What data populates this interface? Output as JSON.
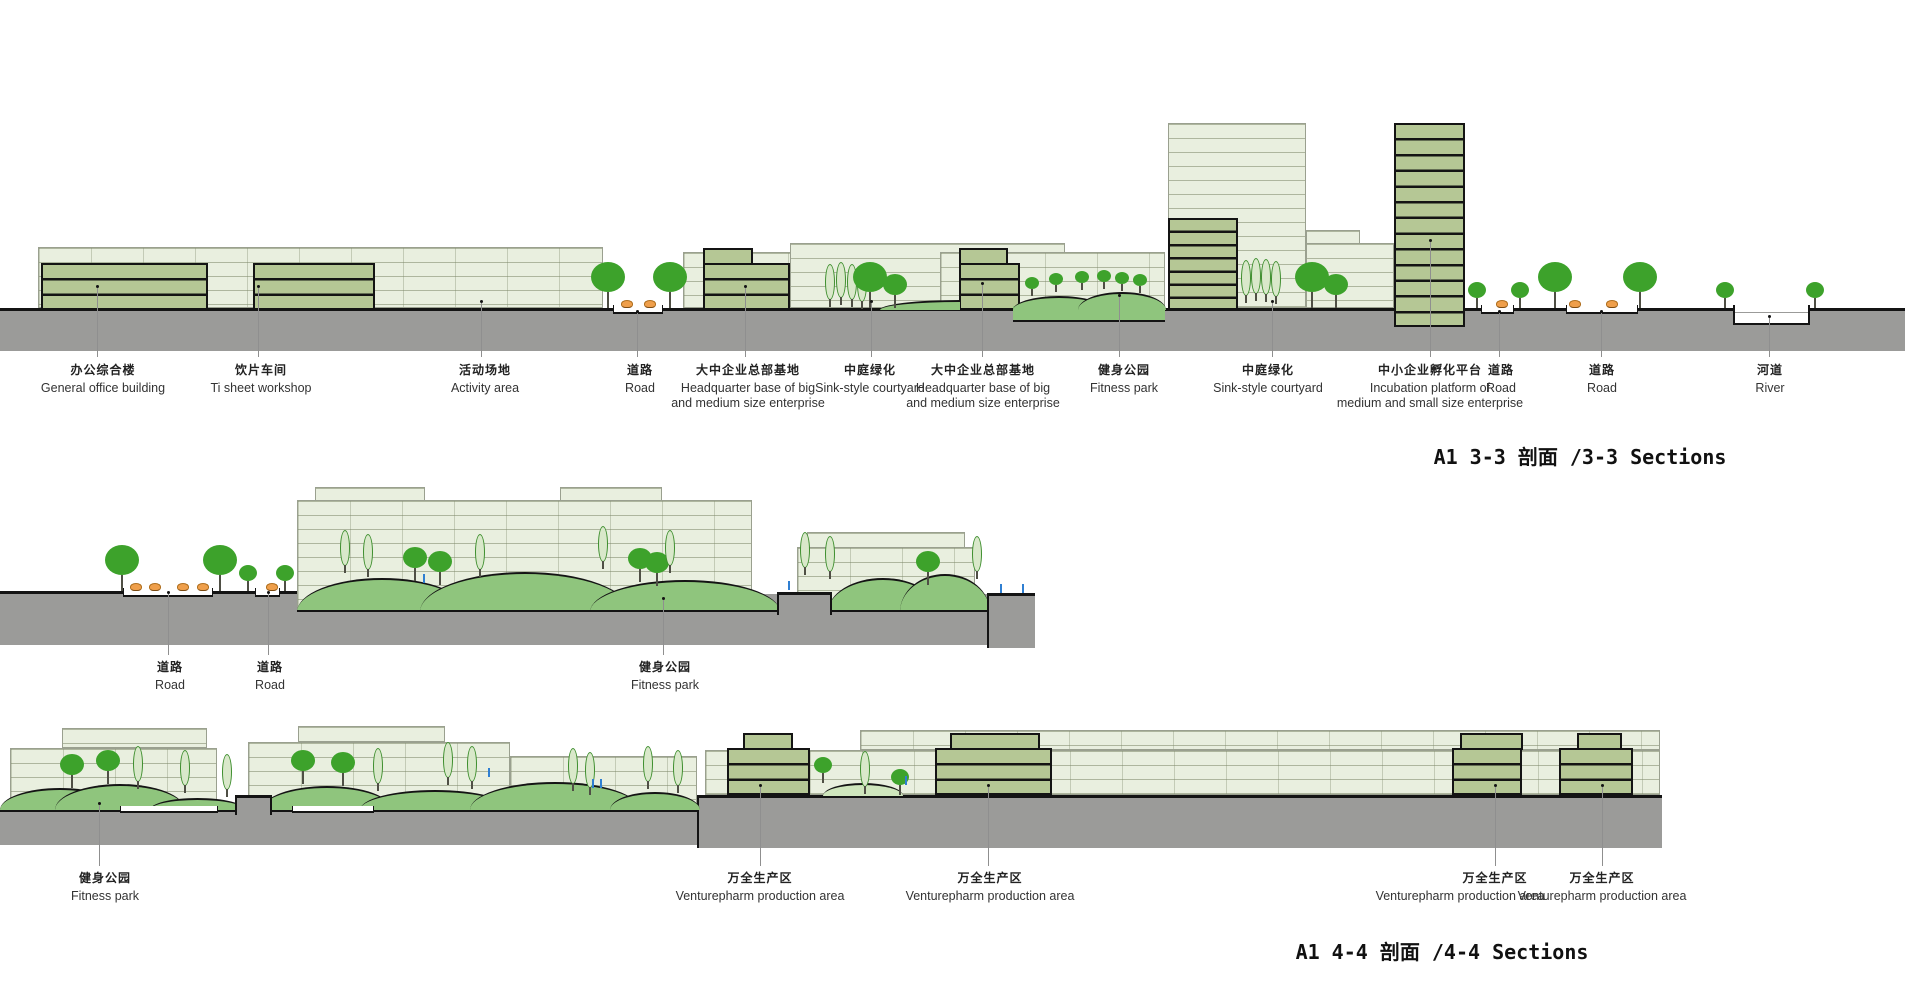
{
  "sections": [
    {
      "id": "3-3",
      "title": "A1 3-3 剖面 /3-3 Sections",
      "labels": [
        {
          "zh": "办公综合楼",
          "en": "General office building"
        },
        {
          "zh": "饮片车间",
          "en": "Ti sheet workshop"
        },
        {
          "zh": "活动场地",
          "en": "Activity area"
        },
        {
          "zh": "道路",
          "en": "Road"
        },
        {
          "zh": "大中企业总部基地",
          "en": "Headquarter base of big",
          "en2": "and medium size enterprise"
        },
        {
          "zh": "中庭绿化",
          "en": "Sink-style courtyard"
        },
        {
          "zh": "大中企业总部基地",
          "en": "Headquarter base of big",
          "en2": "and medium size enterprise"
        },
        {
          "zh": "健身公园",
          "en": "Fitness park"
        },
        {
          "zh": "中庭绿化",
          "en": "Sink-style courtyard"
        },
        {
          "zh": "中小企业孵化平台",
          "en": "Incubation platform of",
          "en2": "medium and small size enterprise"
        },
        {
          "zh": "道路",
          "en": "Road"
        },
        {
          "zh": "道路",
          "en": "Road"
        },
        {
          "zh": "河道",
          "en": "River"
        }
      ]
    },
    {
      "id": "middle-strip",
      "title": "",
      "labels": [
        {
          "zh": "道路",
          "en": "Road"
        },
        {
          "zh": "道路",
          "en": "Road"
        },
        {
          "zh": "健身公园",
          "en": "Fitness park"
        }
      ]
    },
    {
      "id": "4-4",
      "title": "A1 4-4 剖面 /4-4 Sections",
      "labels": [
        {
          "zh": "健身公园",
          "en": "Fitness park"
        },
        {
          "zh": "万全生产区",
          "en": "Venturepharm production area"
        },
        {
          "zh": "万全生产区",
          "en": "Venturepharm production area"
        },
        {
          "zh": "万全生产区",
          "en": "Venturepharm production area"
        },
        {
          "zh": "万全生产区",
          "en": "Venturepharm production area"
        }
      ]
    }
  ],
  "colors": {
    "slab_fill": "#e9efdf",
    "slab_line": "#9aa08f",
    "dark_building": "#b5c795",
    "ground": "#9b9b99",
    "mound": "#8fc57d",
    "mound_light": "#cfe6bd",
    "tree": "#3da22b",
    "poplar_fill": "#d9e8ca",
    "bush": "#ef9f4b",
    "sprinkler": "#2f7fd2",
    "water_line": "#9b9b99",
    "outline": "#141414"
  }
}
